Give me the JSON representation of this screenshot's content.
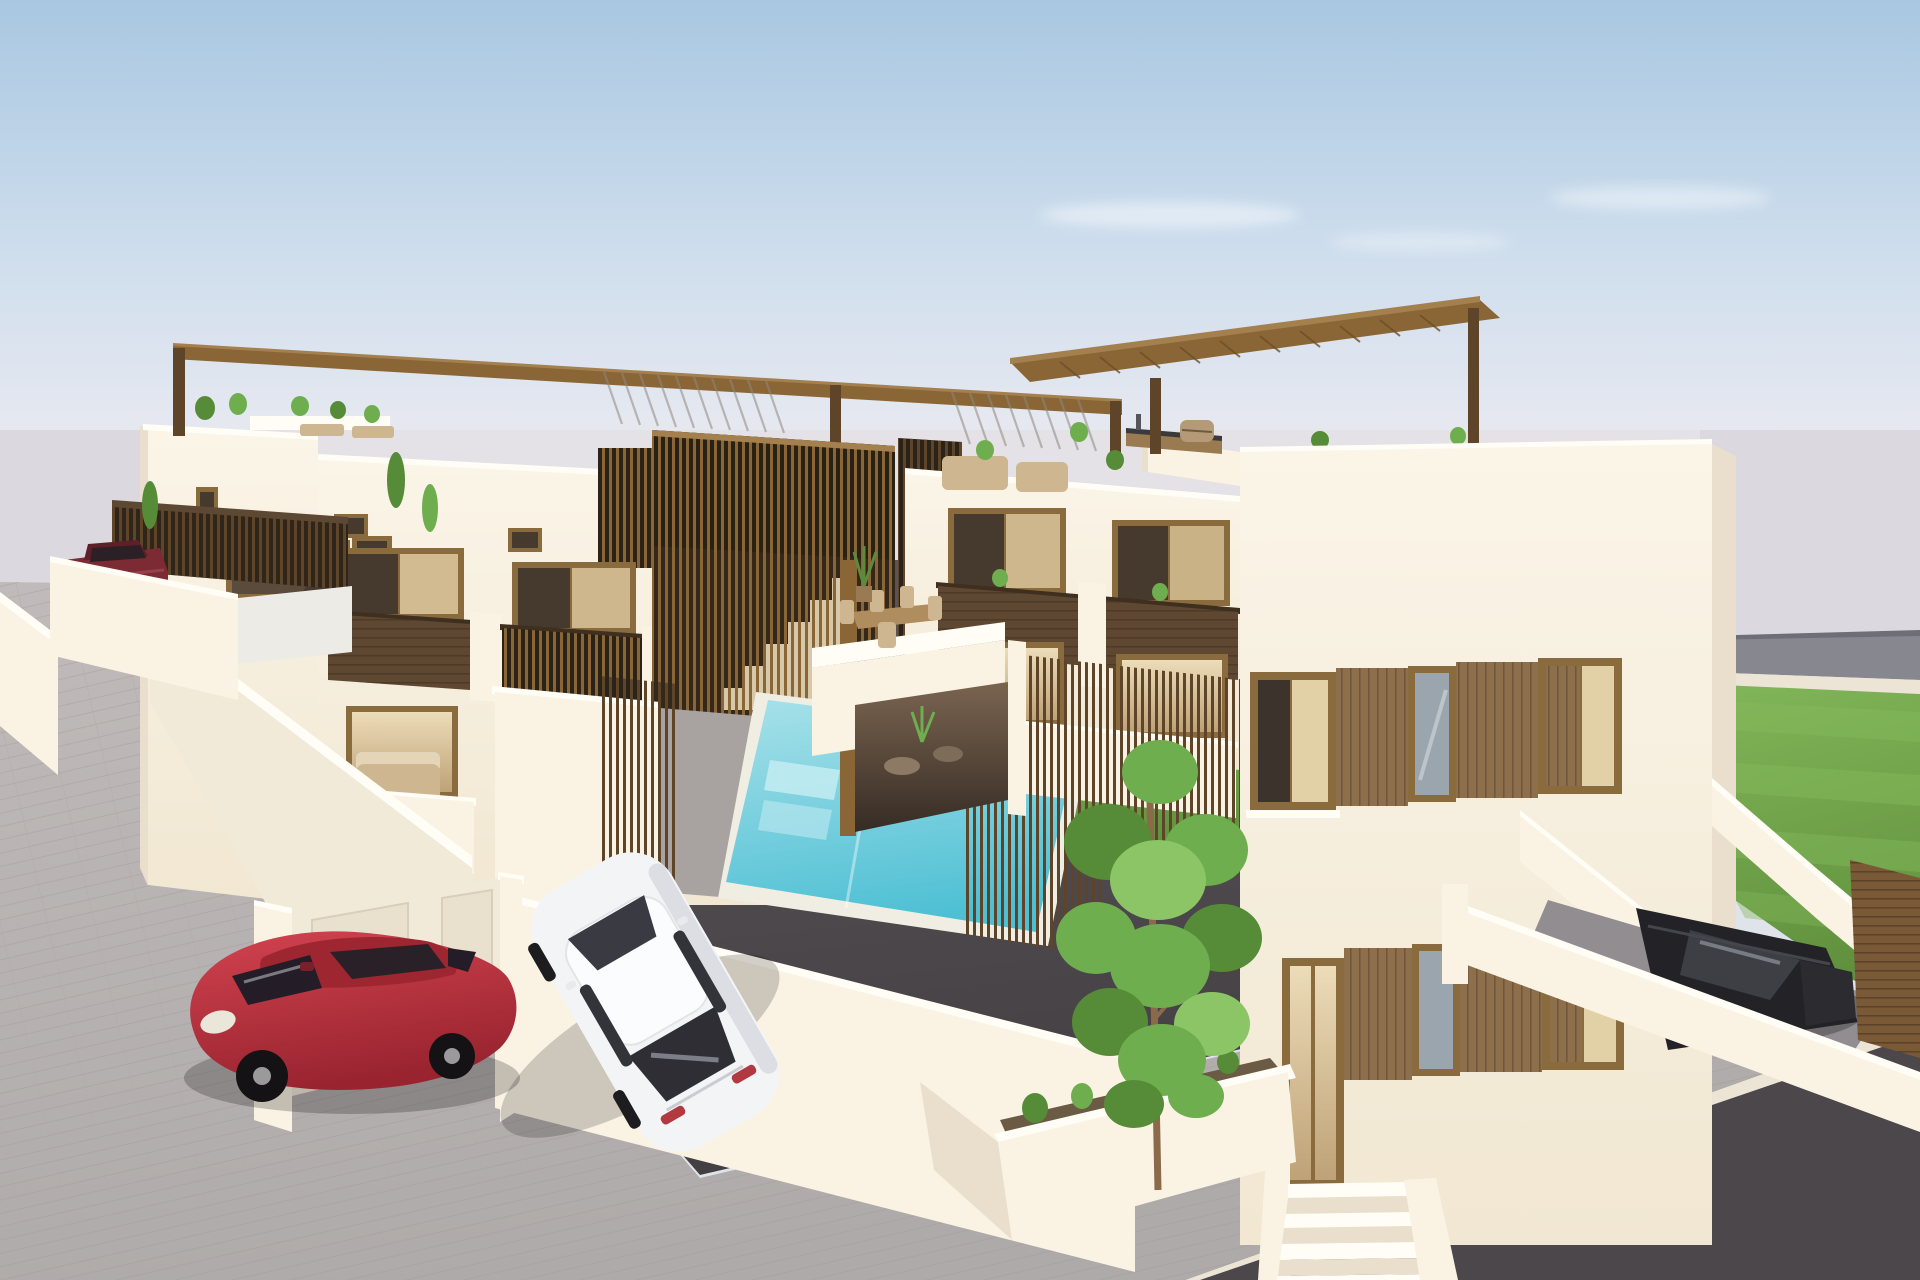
{
  "scene": {
    "type": "3d-architectural-render",
    "setting": "modern-white-townhouse-development",
    "time_of_day": "day",
    "objects": [
      {
        "id": "sky",
        "label": "clear blue sky with faint clouds"
      },
      {
        "id": "sea-haze",
        "label": "pale hazy horizon backdrop"
      },
      {
        "id": "townhouse-row",
        "label": "row of white two-storey townhouses with wooden pergolas"
      },
      {
        "id": "rooftop-pergola",
        "label": "brown rooftop pergola frame"
      },
      {
        "id": "stair-slat-screen",
        "label": "vertical wood slat screens with exterior stairs"
      },
      {
        "id": "roof-terraces",
        "label": "roof terraces with planters and loungers"
      },
      {
        "id": "balconies",
        "label": "balconies with dark wood clad parapets"
      },
      {
        "id": "communal-pool",
        "label": "turquoise communal swimming pool"
      },
      {
        "id": "pool-lawn",
        "label": "small green lawn beside pool"
      },
      {
        "id": "pool-fence",
        "label": "thin wooden slat pool fence"
      },
      {
        "id": "detached-house",
        "label": "large cream detached house with wood framed window bands"
      },
      {
        "id": "rooftop-kitchen",
        "label": "rooftop outdoor kitchen with barbecue"
      },
      {
        "id": "dining-terrace",
        "label": "terrace with outdoor dining table and chairs"
      },
      {
        "id": "covered-patio",
        "label": "covered ground patio with round tables"
      },
      {
        "id": "entrance-stairs",
        "label": "white entrance stairs to raised front door"
      },
      {
        "id": "planter-tree",
        "label": "walled planter with young green tree"
      },
      {
        "id": "garage-ramp",
        "label": "ramp down to private parking with black car"
      },
      {
        "id": "wood-gate",
        "label": "horizontal wood slat gate"
      },
      {
        "id": "garden-lawn",
        "label": "striped mowed lawn"
      },
      {
        "id": "red-hatchback",
        "label": "red hatchback parked on driveway"
      },
      {
        "id": "white-sedan",
        "label": "white sedan parked in court"
      },
      {
        "id": "maroon-car",
        "label": "dark red car behind courtyard wall"
      },
      {
        "id": "utility-cabinets",
        "label": "white street cabinets with cream doors"
      },
      {
        "id": "sidewalk",
        "label": "light paved sidewalk"
      },
      {
        "id": "asphalt-court",
        "label": "dark asphalt driveway court"
      },
      {
        "id": "road",
        "label": "asphalt road at bottom right"
      }
    ]
  },
  "palette": {
    "sky_top": "#a9c7e1",
    "sky_mid": "#cfdeed",
    "sky_low": "#ecebf1",
    "haze": "#dcd8df",
    "road_band": "#87878f",
    "road_band_dark": "#6e6e76",
    "curb": "#ece5d6",
    "lawn": "#72a74b",
    "lawn_light": "#83b75a",
    "lawn_dark": "#5f8f3c",
    "pave_light": "#c0bbba",
    "pave": "#aeaaa9",
    "asphalt_light": "#5d585c",
    "asphalt_dark": "#433f43",
    "road_surface": "#4b474a",
    "wall_bright": "#faf3e4",
    "wall_light": "#f2ead9",
    "wall_shade": "#e9dfcc",
    "wall_cap": "#fffdf5",
    "wood": "#8a6637",
    "wood_light": "#a5804f",
    "wood_dark": "#5e452a",
    "wood_clad": "#8d6f4b",
    "wood_plank": "#5f4832",
    "frame": "#8a6b3e",
    "glass_dark": "#46392d",
    "glass_warm": "#e2d0a6",
    "glass_blue": "#9aa5ae",
    "pool_light": "#a7e1e9",
    "pool_deep": "#4fc0d4",
    "coping": "#f0ede3",
    "tree": "#6fae4e",
    "tree_dark": "#568c38",
    "tree_light": "#8cc566",
    "trunk": "#8a6a48",
    "car_red": "#c0333f",
    "car_red_dark": "#9e2631",
    "car_white": "#f3f4f6",
    "car_white_shade": "#dcdee3",
    "car_black": "#232327",
    "car_maroon": "#7c2a34",
    "soil": "#6b5a44",
    "furniture_tan": "#cdb690",
    "gate_wood": "#7a5936"
  }
}
